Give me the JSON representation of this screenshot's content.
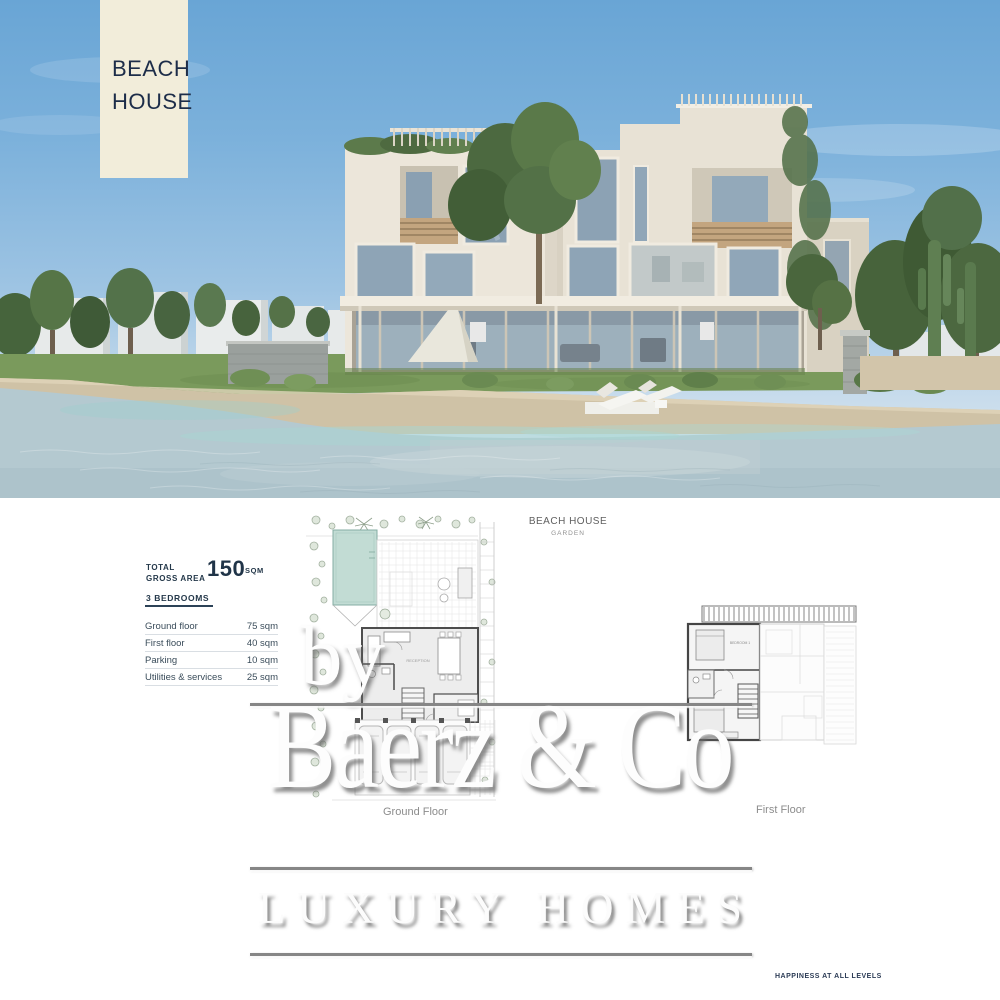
{
  "banner": {
    "line1": "BEACH",
    "line2": "HOUSE"
  },
  "specs": {
    "total_label_line1": "TOTAL",
    "total_label_line2": "GROSS AREA",
    "total_value": "150",
    "total_unit": "SQM",
    "bedrooms": "3 BEDROOMS",
    "rows": [
      {
        "label": "Ground floor",
        "value": "75 sqm"
      },
      {
        "label": "First floor",
        "value": "40 sqm"
      },
      {
        "label": "Parking",
        "value": "10 sqm"
      },
      {
        "label": "Utilities & services",
        "value": "25 sqm"
      }
    ]
  },
  "plans": {
    "title": "BEACH HOUSE",
    "subtitle": "GARDEN",
    "ground_label": "Ground Floor",
    "first_label": "First Floor",
    "room_reception": "RECEPTION",
    "room_bedroom": "BEDROOM 1"
  },
  "watermark": {
    "prefix": "by",
    "name": "Baerz & Co",
    "tagline": "LUXURY HOMES"
  },
  "footer": {
    "tagline": "HAPPINESS AT ALL LEVELS"
  },
  "colors": {
    "accent_navy": "#24384a",
    "banner_cream": "#f2edda",
    "sky": "#6fa9d6",
    "water": "#b4c9d0",
    "sand": "#cfc2a6",
    "facade": "#ebe5d9",
    "pool_teal": "#bcd8d0",
    "watermark_gray": "#868686"
  }
}
